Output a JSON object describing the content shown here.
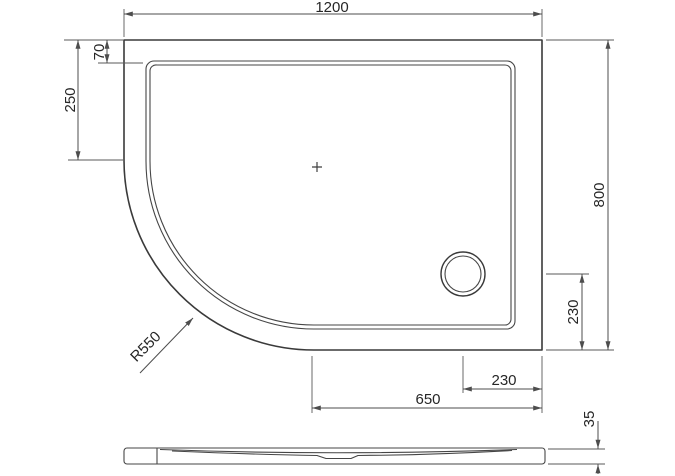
{
  "drawing": {
    "kind": "shower-tray-technical-drawing",
    "line_color": "#3a3a3a",
    "dimension_color": "#4d4d4d",
    "text_color": "#262626",
    "dims": {
      "overall_width": "1200",
      "overall_depth": "800",
      "rim_width": "70",
      "left_straight_edge": "250",
      "drain_to_bottom_edge": "230",
      "drain_to_right_edge": "230",
      "bottom_straight_edge": "650",
      "tray_height": "35",
      "corner_radius": "R550"
    }
  }
}
